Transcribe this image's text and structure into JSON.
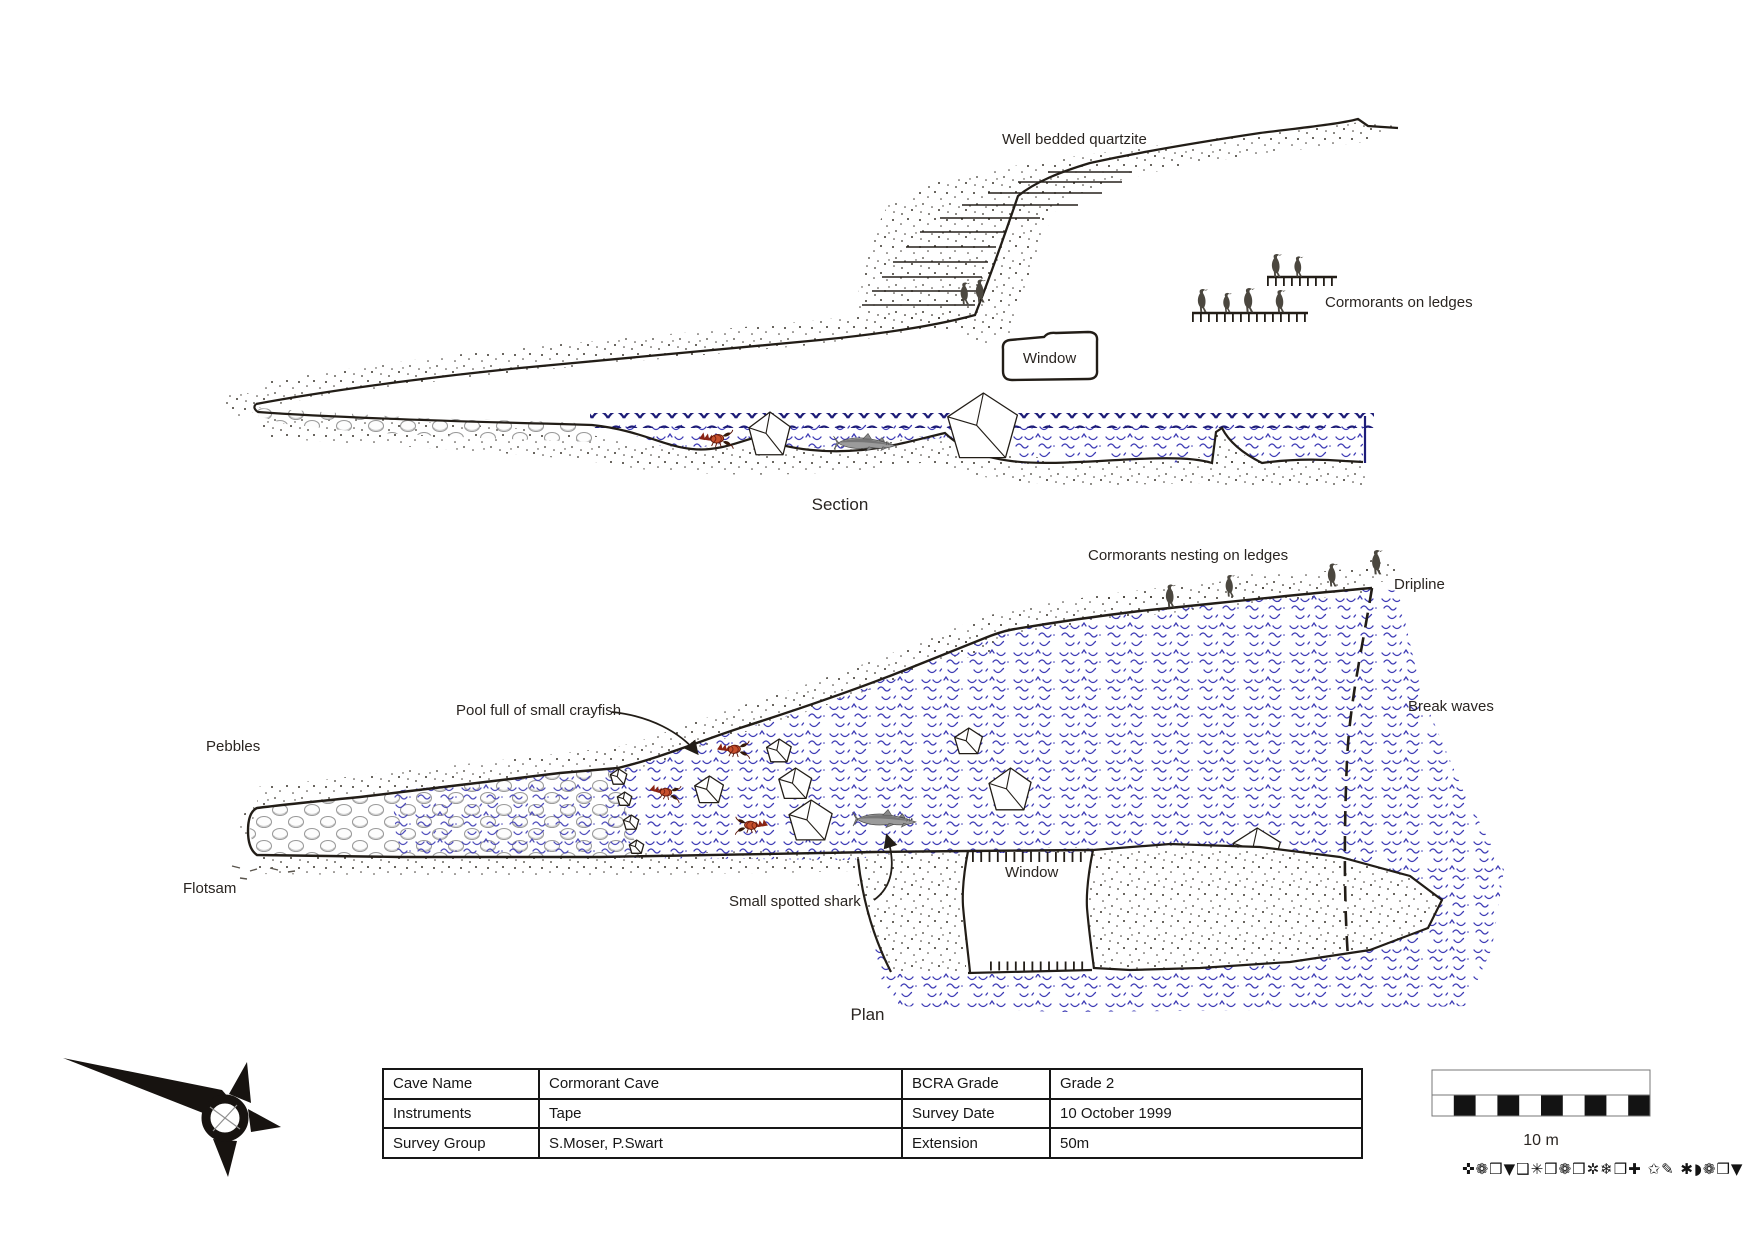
{
  "section": {
    "title": "Section",
    "labels": {
      "quartzite": "Well bedded quartzite",
      "cormorants": "Cormorants on ledges",
      "window": "Window"
    }
  },
  "plan": {
    "title": "Plan",
    "labels": {
      "cormorants_nesting": "Cormorants nesting on ledges",
      "dripline": "Dripline",
      "break_waves": "Break waves",
      "pool_crayfish": "Pool full of small crayfish",
      "pebbles": "Pebbles",
      "flotsam": "Flotsam",
      "small_spotted_shark": "Small spotted shark",
      "window": "Window"
    }
  },
  "info_table": {
    "rows": [
      [
        "Cave Name",
        "Cormorant Cave",
        "BCRA Grade",
        "Grade 2"
      ],
      [
        "Instruments",
        "Tape",
        "Survey Date",
        "10 October 1999"
      ],
      [
        "Survey Group",
        "S.Moser, P.Swart",
        "Extension",
        "50m"
      ]
    ]
  },
  "scale_bar": {
    "label": "10 m"
  },
  "footer_symbols": "✜❁❒▼❑✳❒❁❒✲❄❒✚ ✩✎ ✱◗❁❒▼",
  "colors": {
    "water_symbol": "#3e3cb5",
    "water_crest": "#1e1d78",
    "ink": "#221d17",
    "crayfish_red": "#c7502c",
    "bird_gray": "#4b473f"
  }
}
